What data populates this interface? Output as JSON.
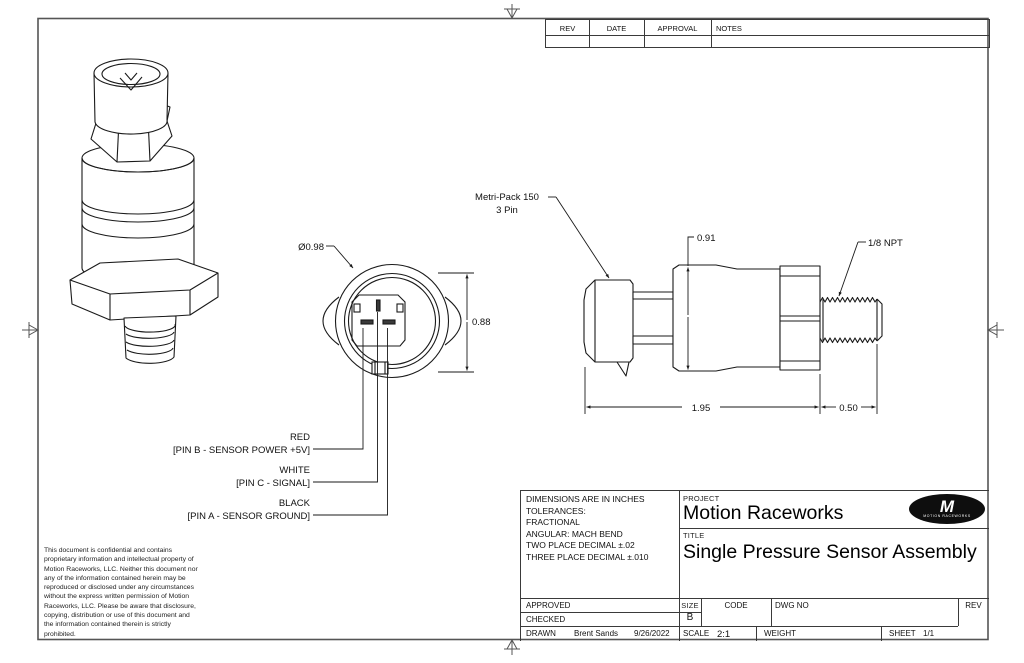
{
  "rev_table": {
    "headers": [
      "REV",
      "DATE",
      "APPROVAL",
      "NOTES"
    ]
  },
  "drawing": {
    "front_view": {
      "diameter": "Ø0.98",
      "height": "0.88"
    },
    "side_view": {
      "connector_line1": "Metri-Pack 150",
      "connector_line2": "3 Pin",
      "height": "0.91",
      "thread_spec": "1/8 NPT",
      "body_length": "1.95",
      "thread_length": "0.50"
    },
    "pins": [
      {
        "wire": "RED",
        "pin": "[PIN B - SENSOR POWER +5V]"
      },
      {
        "wire": "WHITE",
        "pin": "[PIN C - SIGNAL]"
      },
      {
        "wire": "BLACK",
        "pin": "[PIN A - SENSOR GROUND]"
      }
    ]
  },
  "confidentiality": {
    "lines": [
      "This document is confidential and contains",
      "proprietary information and intellectual property of",
      "Motion Raceworks, LLC. Neither this document nor",
      "any of the information contained herein may be",
      "reproduced or disclosed under any circumstances",
      "without the express written permission of Motion",
      "Raceworks, LLC. Please be aware that disclosure,",
      "copying, distribution or use of this document and",
      "the information contained therein is strictly",
      "prohibited."
    ]
  },
  "title_block": {
    "tolerance_notes": [
      "DIMENSIONS ARE IN INCHES",
      "TOLERANCES:",
      "FRACTIONAL",
      "ANGULAR: MACH BEND",
      "TWO PLACE DECIMAL ±.02",
      "THREE PLACE DECIMAL ±.010"
    ],
    "project_label": "PROJECT",
    "project_name": "Motion Raceworks",
    "title_label": "TITLE",
    "title_name": "Single Pressure Sensor Assembly",
    "approved_label": "APPROVED",
    "checked_label": "CHECKED",
    "drawn_label": "DRAWN",
    "drawn_by": "Brent Sands",
    "drawn_date": "9/26/2022",
    "size_label": "SIZE",
    "size_value": "B",
    "code_label": "CODE",
    "dwg_no_label": "DWG NO",
    "rev_label": "REV",
    "scale_label": "SCALE",
    "scale_value": "2:1",
    "weight_label": "WEIGHT",
    "sheet_label": "SHEET",
    "sheet_value": "1/1",
    "logo_letter": "M",
    "logo_text": "MOTION RACEWORKS"
  }
}
